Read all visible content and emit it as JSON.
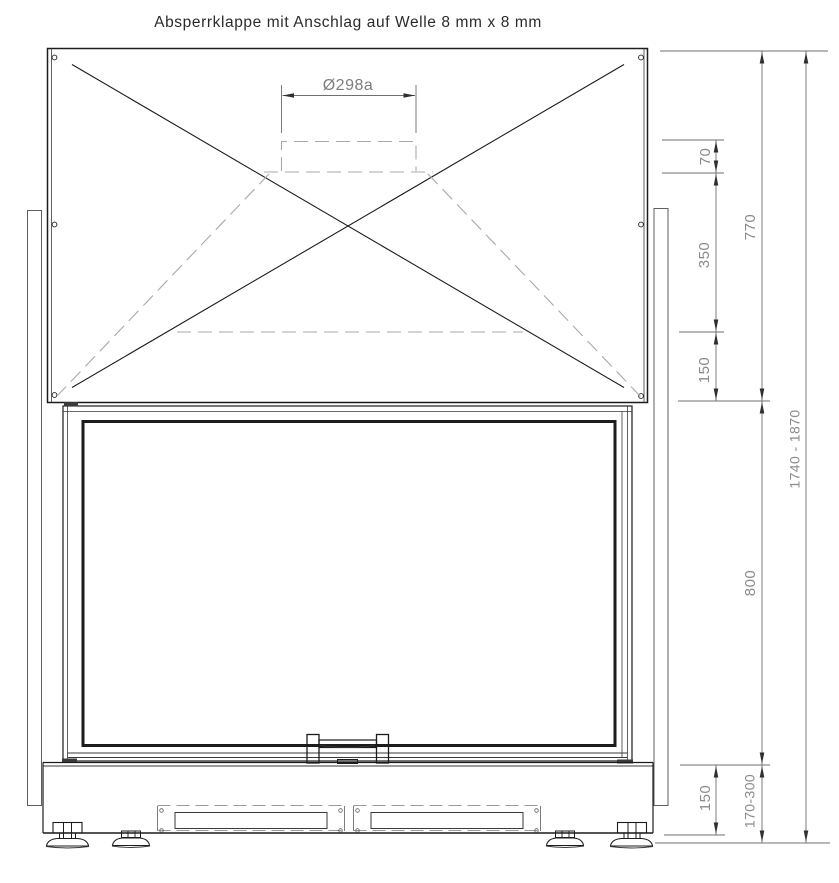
{
  "title": "Absperrklappe mit Anschlag auf Welle 8 mm x 8 mm",
  "dimensions": {
    "collar_diameter": "Ø298a",
    "collar_height": "70",
    "upper_spacing": "350",
    "lower_spacing": "150",
    "top_section_height": "770",
    "firebox_height": "800",
    "base_height": "150",
    "base_adjust_range": "170-300",
    "total_height_range": "1740 - 1870"
  }
}
